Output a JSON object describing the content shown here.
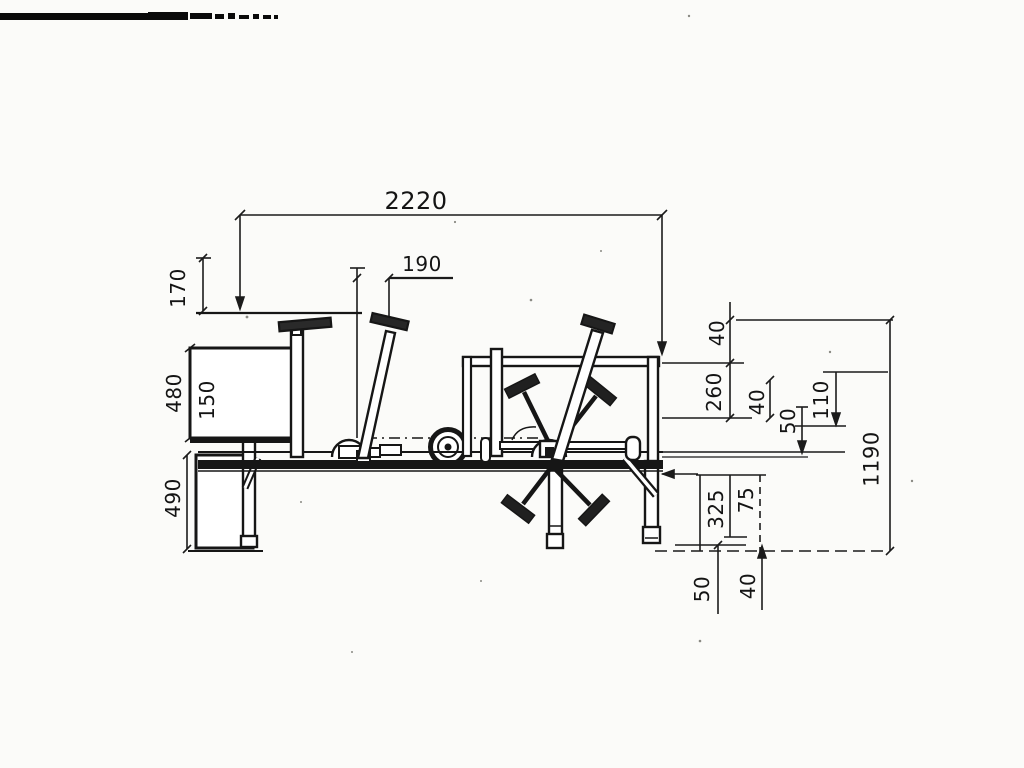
{
  "dimensions": {
    "overall_width": "2220",
    "handle_offset": "190",
    "upper_left_height": "170",
    "panel_height": "480",
    "panel_depth": "150",
    "lower_panel_height": "490",
    "right_upper_gap": "40",
    "frame_drop": "260",
    "right_mid_gap": "40",
    "axle_drop": "50",
    "side_offset": "110",
    "overall_height": "1190",
    "leg_span": "325",
    "leg_offset": "75",
    "ground_left": "50",
    "ground_right": "40"
  }
}
